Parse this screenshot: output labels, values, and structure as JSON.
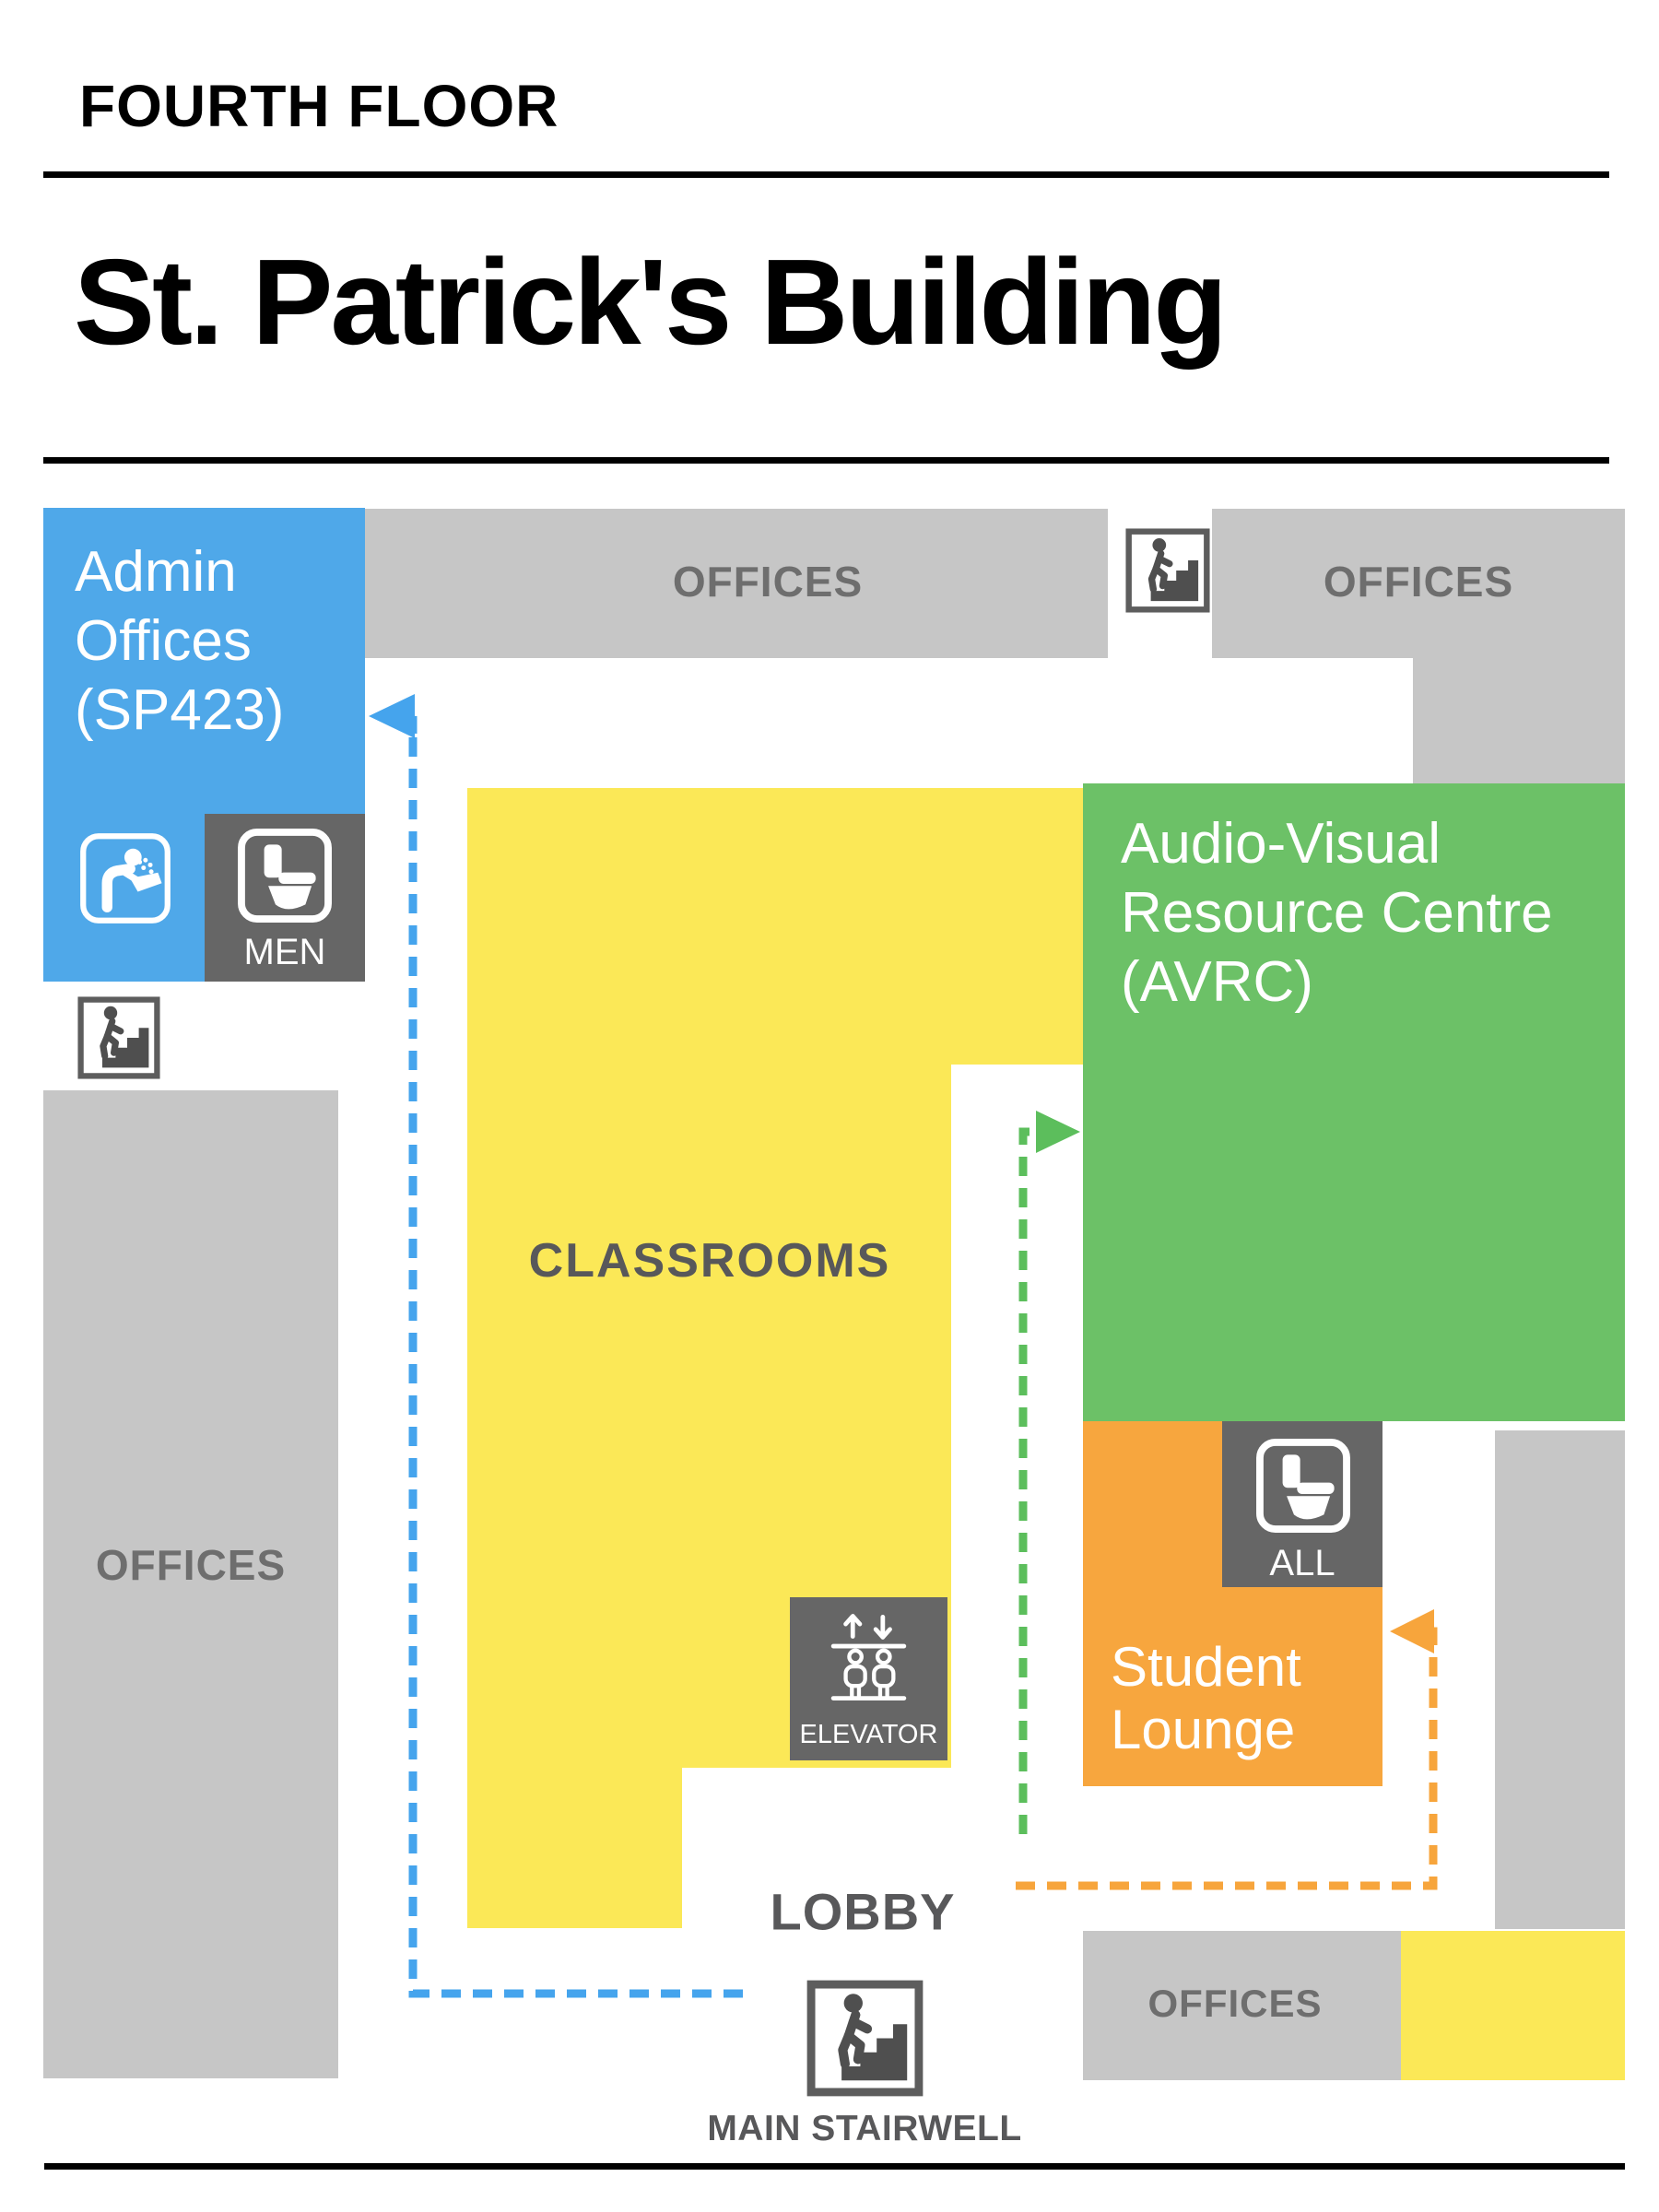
{
  "header": {
    "floor_label": "FOURTH FLOOR",
    "building_title": "St. Patrick's Building"
  },
  "rooms": {
    "admin_offices": {
      "label": "Admin\nOffices\n(SP423)"
    },
    "offices_top": {
      "label": "OFFICES"
    },
    "offices_top_right": {
      "label": "OFFICES"
    },
    "offices_left": {
      "label": "OFFICES"
    },
    "offices_bottom_right": {
      "label": "OFFICES"
    },
    "classrooms": {
      "label": "CLASSROOMS"
    },
    "avrc": {
      "label": "Audio-Visual\nResource Centre\n(AVRC)"
    },
    "student_lounge": {
      "label": "Student\nLounge"
    },
    "lobby": {
      "label": "LOBBY"
    }
  },
  "facilities": {
    "mens_restroom": {
      "label": "MEN"
    },
    "all_gender_restroom": {
      "label": "ALL"
    },
    "elevator": {
      "label": "ELEVATOR"
    },
    "main_stairwell": {
      "label": "MAIN STAIRWELL"
    }
  },
  "icons": {
    "water_fountain": "water-fountain-icon",
    "toilet": "toilet-icon",
    "stairs": "stairs-icon",
    "elevator": "elevator-icon"
  },
  "colors": {
    "blue": "#4FA8E9",
    "yellow": "#FBE857",
    "green": "#6CC167",
    "orange": "#F7A63E",
    "gray_light": "#C6C6C6",
    "gray_dark": "#666666",
    "text_dark": "#58585A",
    "text_gray": "#6E6E6E",
    "arrow_blue": "#45A4ED",
    "arrow_green": "#5CBE5C",
    "arrow_orange": "#F7A53C",
    "black": "#000000"
  }
}
